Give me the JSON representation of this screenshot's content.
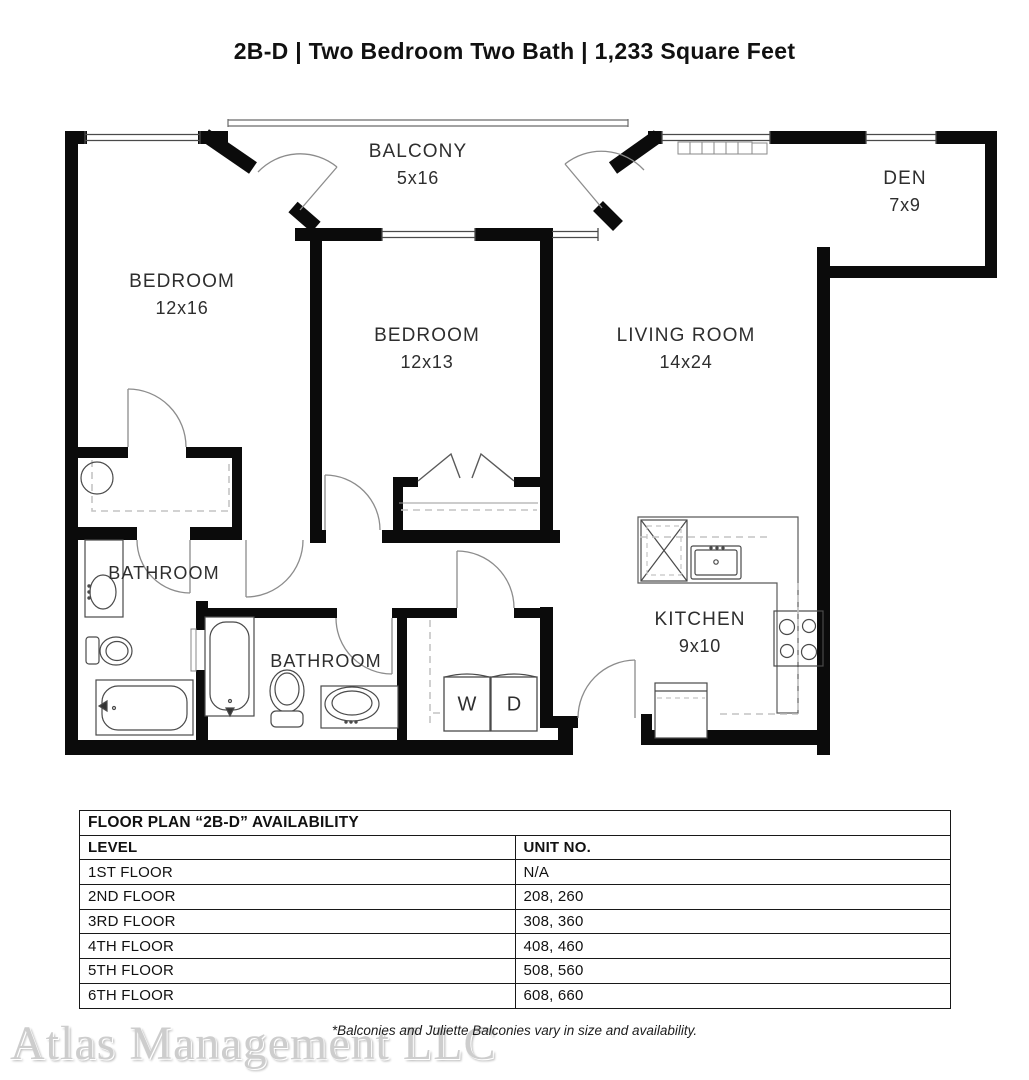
{
  "page_title": "2B-D | Two Bedroom Two Bath | 1,233 Square Feet",
  "floor_plan": {
    "rooms": {
      "balcony": {
        "name": "BALCONY",
        "dims": "5x16"
      },
      "den": {
        "name": "DEN",
        "dims": "7x9"
      },
      "bedroom1": {
        "name": "BEDROOM",
        "dims": "12x16"
      },
      "bedroom2": {
        "name": "BEDROOM",
        "dims": "12x13"
      },
      "living_room": {
        "name": "LIVING ROOM",
        "dims": "14x24"
      },
      "kitchen": {
        "name": "KITCHEN",
        "dims": "9x10"
      },
      "bathroom1": {
        "name": "BATHROOM"
      },
      "bathroom2": {
        "name": "BATHROOM"
      }
    },
    "appliances": {
      "washer": "W",
      "dryer": "D"
    }
  },
  "availability_table": {
    "title": "FLOOR PLAN “2B-D” AVAILABILITY",
    "columns": [
      "LEVEL",
      "UNIT NO."
    ],
    "rows": [
      {
        "level": "1ST FLOOR",
        "units": "N/A"
      },
      {
        "level": "2ND FLOOR",
        "units": "208, 260"
      },
      {
        "level": "3RD FLOOR",
        "units": "308, 360"
      },
      {
        "level": "4TH FLOOR",
        "units": "408, 460"
      },
      {
        "level": "5TH FLOOR",
        "units": "508, 560"
      },
      {
        "level": "6TH FLOOR",
        "units": "608, 660"
      }
    ]
  },
  "footnote": "*Balconies and Juliette Balconies vary in size and availability.",
  "watermark": "Atlas Management LLC",
  "colors": {
    "wall": "#0b0b0b",
    "line": "#4a4a4a",
    "dash": "#c4c4c4",
    "text": "#2e2e2e"
  }
}
